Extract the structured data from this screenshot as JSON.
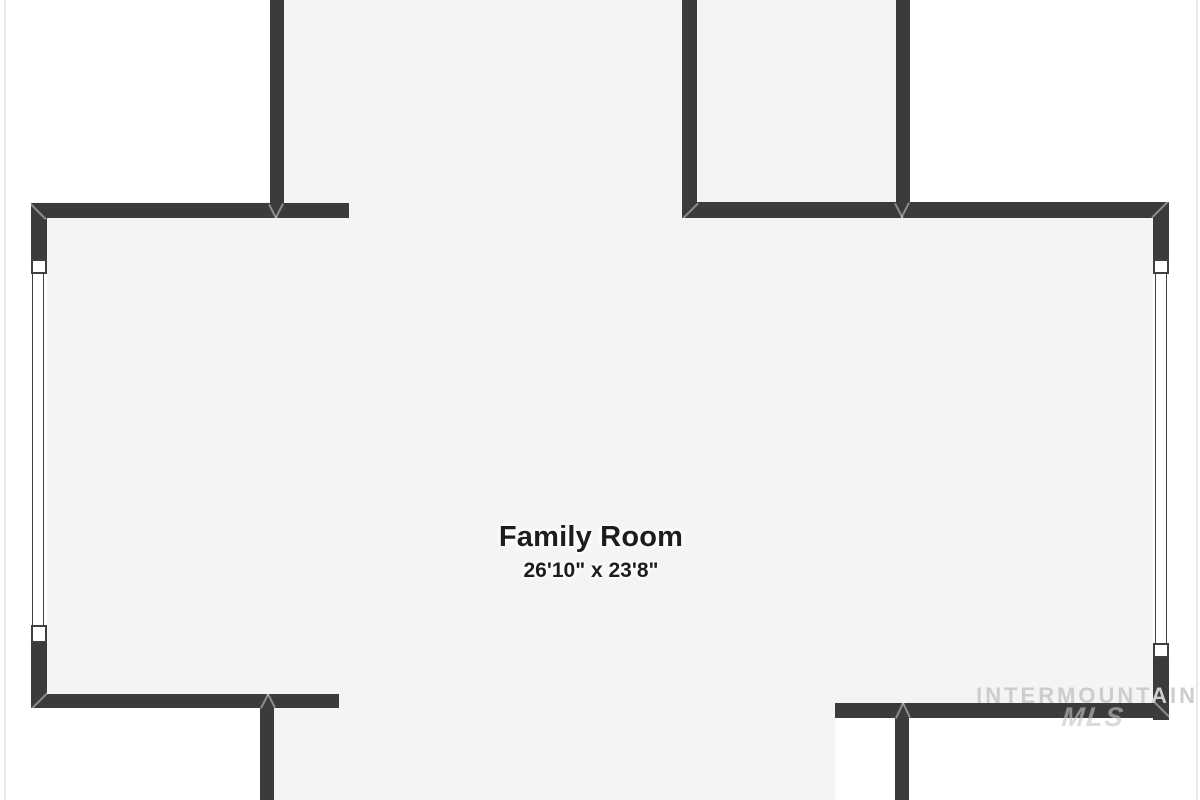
{
  "floorplan": {
    "room": {
      "label": "Family Room",
      "dimensions": "26'10\" x 23'8\""
    },
    "watermark": {
      "line1": "INTERMOUNTAIN",
      "line2": "MLS"
    },
    "colors": {
      "wall": "#3b3b3b",
      "floor": "#f4f4f4",
      "background": "#ffffff",
      "label_text": "#1d1d1d",
      "watermark_text": "#cdcdcd"
    }
  }
}
